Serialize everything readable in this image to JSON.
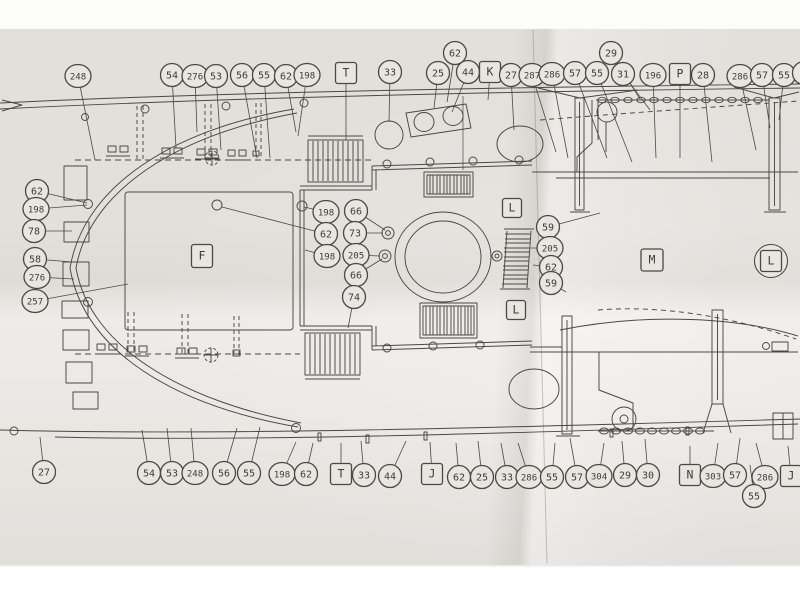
{
  "meta": {
    "title": "Ship deck plan sheet (folded blueprint photograph)"
  },
  "colors": {
    "paper": "#e9e6e2",
    "background": "#fcfcfb",
    "ink": "#4b4843"
  },
  "plan": {
    "callouts": [
      {
        "label": "248",
        "shape": "circle",
        "x": 78,
        "y": 76,
        "tx": 95,
        "ty": 160
      },
      {
        "label": "54",
        "shape": "circle",
        "x": 172,
        "y": 75,
        "tx": 176,
        "ty": 148
      },
      {
        "label": "276",
        "shape": "circle",
        "x": 195,
        "y": 76,
        "tx": 197,
        "ty": 132
      },
      {
        "label": "53",
        "shape": "circle",
        "x": 216,
        "y": 76,
        "tx": 221,
        "ty": 150
      },
      {
        "label": "56",
        "shape": "circle",
        "x": 242,
        "y": 75,
        "tx": 257,
        "ty": 158
      },
      {
        "label": "55",
        "shape": "circle",
        "x": 264,
        "y": 75,
        "tx": 270,
        "ty": 158
      },
      {
        "label": "62",
        "shape": "circle",
        "x": 286,
        "y": 76,
        "tx": 296,
        "ty": 132
      },
      {
        "label": "198",
        "shape": "circle",
        "x": 307,
        "y": 75,
        "tx": 298,
        "ty": 136
      },
      {
        "label": "T",
        "shape": "square",
        "x": 346,
        "y": 73,
        "tx": 346,
        "ty": 140
      },
      {
        "label": "33",
        "shape": "circle",
        "x": 390,
        "y": 72,
        "tx": 389,
        "ty": 122
      },
      {
        "label": "25",
        "shape": "circle",
        "x": 438,
        "y": 73,
        "tx": 434,
        "ty": 108
      },
      {
        "label": "62",
        "shape": "circle",
        "x": 455,
        "y": 53,
        "tx": 447,
        "ty": 102
      },
      {
        "label": "44",
        "shape": "circle",
        "x": 468,
        "y": 72,
        "tx": 452,
        "ty": 112
      },
      {
        "label": "K",
        "shape": "square",
        "x": 490,
        "y": 72,
        "tx": 488,
        "ty": 100
      },
      {
        "label": "27",
        "shape": "circle",
        "x": 511,
        "y": 75,
        "tx": 514,
        "ty": 130
      },
      {
        "label": "287",
        "shape": "circle",
        "x": 532,
        "y": 75,
        "tx": 556,
        "ty": 152
      },
      {
        "label": "286",
        "shape": "circle",
        "x": 552,
        "y": 74,
        "tx": 568,
        "ty": 158
      },
      {
        "label": "57",
        "shape": "circle",
        "x": 575,
        "y": 73,
        "tx": 607,
        "ty": 158
      },
      {
        "label": "55",
        "shape": "circle",
        "x": 597,
        "y": 73,
        "tx": 632,
        "ty": 162
      },
      {
        "label": "29",
        "shape": "circle",
        "x": 611,
        "y": 53,
        "tx": 640,
        "ty": 99
      },
      {
        "label": "31",
        "shape": "circle",
        "x": 623,
        "y": 74,
        "tx": 650,
        "ty": 110
      },
      {
        "label": "196",
        "shape": "circle",
        "x": 653,
        "y": 75,
        "tx": 656,
        "ty": 158
      },
      {
        "label": "P",
        "shape": "square",
        "x": 680,
        "y": 74,
        "tx": 680,
        "ty": 158
      },
      {
        "label": "28",
        "shape": "circle",
        "x": 703,
        "y": 75,
        "tx": 712,
        "ty": 162
      },
      {
        "label": "286",
        "shape": "circle",
        "x": 740,
        "y": 76,
        "tx": 756,
        "ty": 150
      },
      {
        "label": "57",
        "shape": "circle",
        "x": 762,
        "y": 75,
        "tx": 770,
        "ty": 128
      },
      {
        "label": "55",
        "shape": "circle",
        "x": 784,
        "y": 75,
        "tx": 779,
        "ty": 120
      },
      {
        "label": "",
        "shape": "circle",
        "x": 804,
        "y": 73
      },
      {
        "label": "62",
        "shape": "circle",
        "x": 37,
        "y": 191,
        "tx": 87,
        "ty": 203
      },
      {
        "label": "198",
        "shape": "circle",
        "x": 36,
        "y": 209,
        "tx": 87,
        "ty": 205
      },
      {
        "label": "78",
        "shape": "circle",
        "x": 34,
        "y": 231,
        "tx": 72,
        "ty": 231
      },
      {
        "label": "58",
        "shape": "circle",
        "x": 35,
        "y": 259,
        "tx": 72,
        "ty": 262
      },
      {
        "label": "276",
        "shape": "circle",
        "x": 37,
        "y": 277,
        "tx": 74,
        "ty": 279
      },
      {
        "label": "257",
        "shape": "circle",
        "x": 35,
        "y": 301,
        "tx": 128,
        "ty": 284
      },
      {
        "label": "198",
        "shape": "circle",
        "x": 326,
        "y": 212,
        "tx": 304,
        "ty": 207
      },
      {
        "label": "62",
        "shape": "circle",
        "x": 326,
        "y": 234,
        "tx": 222,
        "ty": 207
      },
      {
        "label": "198",
        "shape": "circle",
        "x": 327,
        "y": 256,
        "tx": 305,
        "ty": 250
      },
      {
        "label": "66",
        "shape": "circle",
        "x": 356,
        "y": 211,
        "tx": 385,
        "ty": 230
      },
      {
        "label": "73",
        "shape": "circle",
        "x": 355,
        "y": 233,
        "tx": 383,
        "ty": 233
      },
      {
        "label": "205",
        "shape": "circle",
        "x": 356,
        "y": 255,
        "tx": 380,
        "ty": 256
      },
      {
        "label": "66",
        "shape": "circle",
        "x": 356,
        "y": 275,
        "tx": 382,
        "ty": 259
      },
      {
        "label": "74",
        "shape": "circle",
        "x": 354,
        "y": 297,
        "tx": 348,
        "ty": 328
      },
      {
        "label": "F",
        "shape": "square",
        "x": 202,
        "y": 256,
        "w": 21,
        "h": 23
      },
      {
        "label": "L",
        "shape": "square",
        "x": 512,
        "y": 208,
        "w": 19,
        "h": 19
      },
      {
        "label": "59",
        "shape": "circle",
        "x": 548,
        "y": 227,
        "tx": 600,
        "ty": 213
      },
      {
        "label": "205",
        "shape": "circle",
        "x": 550,
        "y": 248,
        "tx": 530,
        "ty": 248
      },
      {
        "label": "62",
        "shape": "circle",
        "x": 551,
        "y": 267,
        "tx": 533,
        "ty": 265
      },
      {
        "label": "59",
        "shape": "circle",
        "x": 551,
        "y": 283,
        "tx": 566,
        "ty": 292
      },
      {
        "label": "L",
        "shape": "square",
        "x": 516,
        "y": 310,
        "w": 19,
        "h": 19
      },
      {
        "label": "M",
        "shape": "square",
        "x": 652,
        "y": 260,
        "w": 22,
        "h": 22
      },
      {
        "label": "L",
        "shape": "square-circle",
        "x": 771,
        "y": 261
      },
      {
        "label": "27",
        "shape": "circle",
        "x": 44,
        "y": 472,
        "tx": 40,
        "ty": 437
      },
      {
        "label": "54",
        "shape": "circle",
        "x": 149,
        "y": 473,
        "tx": 142,
        "ty": 430
      },
      {
        "label": "53",
        "shape": "circle",
        "x": 172,
        "y": 473,
        "tx": 167,
        "ty": 428
      },
      {
        "label": "248",
        "shape": "circle",
        "x": 195,
        "y": 473,
        "tx": 191,
        "ty": 428
      },
      {
        "label": "56",
        "shape": "circle",
        "x": 224,
        "y": 473,
        "tx": 237,
        "ty": 428
      },
      {
        "label": "55",
        "shape": "circle",
        "x": 249,
        "y": 473,
        "tx": 260,
        "ty": 427
      },
      {
        "label": "198",
        "shape": "circle",
        "x": 282,
        "y": 474,
        "tx": 296,
        "ty": 442
      },
      {
        "label": "62",
        "shape": "circle",
        "x": 306,
        "y": 474,
        "tx": 313,
        "ty": 443
      },
      {
        "label": "T",
        "shape": "square",
        "x": 341,
        "y": 474,
        "tx": 341,
        "ty": 443
      },
      {
        "label": "33",
        "shape": "circle",
        "x": 364,
        "y": 475,
        "tx": 361,
        "ty": 441
      },
      {
        "label": "44",
        "shape": "circle",
        "x": 390,
        "y": 476,
        "tx": 406,
        "ty": 441
      },
      {
        "label": "J",
        "shape": "square",
        "x": 432,
        "y": 474,
        "tx": 430,
        "ty": 442
      },
      {
        "label": "62",
        "shape": "circle",
        "x": 459,
        "y": 477,
        "tx": 456,
        "ty": 443
      },
      {
        "label": "25",
        "shape": "circle",
        "x": 482,
        "y": 477,
        "tx": 478,
        "ty": 441
      },
      {
        "label": "33",
        "shape": "circle",
        "x": 507,
        "y": 477,
        "tx": 501,
        "ty": 443
      },
      {
        "label": "286",
        "shape": "circle",
        "x": 529,
        "y": 477,
        "tx": 518,
        "ty": 443
      },
      {
        "label": "55",
        "shape": "circle",
        "x": 552,
        "y": 477,
        "tx": 555,
        "ty": 443
      },
      {
        "label": "57",
        "shape": "circle",
        "x": 577,
        "y": 477,
        "tx": 570,
        "ty": 438
      },
      {
        "label": "304",
        "shape": "circle",
        "x": 599,
        "y": 476,
        "tx": 604,
        "ty": 443
      },
      {
        "label": "29",
        "shape": "circle",
        "x": 625,
        "y": 475,
        "tx": 622,
        "ty": 441
      },
      {
        "label": "30",
        "shape": "circle",
        "x": 648,
        "y": 475,
        "tx": 645,
        "ty": 439
      },
      {
        "label": "N",
        "shape": "square",
        "x": 690,
        "y": 475,
        "tx": 690,
        "ty": 446
      },
      {
        "label": "303",
        "shape": "circle",
        "x": 713,
        "y": 476,
        "tx": 718,
        "ty": 443
      },
      {
        "label": "57",
        "shape": "circle",
        "x": 735,
        "y": 475,
        "tx": 740,
        "ty": 438
      },
      {
        "label": "286",
        "shape": "circle",
        "x": 765,
        "y": 477,
        "tx": 756,
        "ty": 443
      },
      {
        "label": "55",
        "shape": "circle",
        "x": 754,
        "y": 496,
        "tx": 750,
        "ty": 465
      },
      {
        "label": "J",
        "shape": "square",
        "x": 791,
        "y": 476,
        "tx": 788,
        "ty": 446
      }
    ]
  }
}
